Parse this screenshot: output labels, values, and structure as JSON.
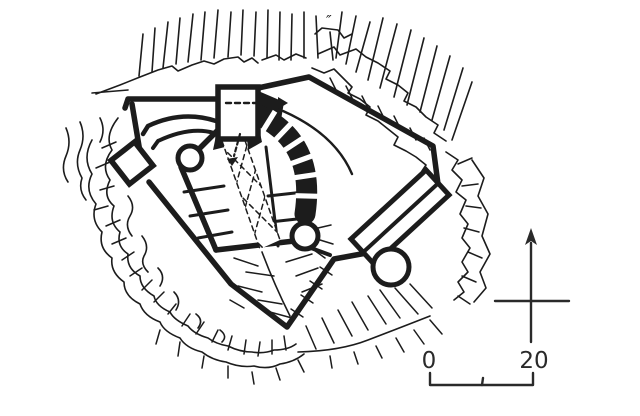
{
  "figure": {
    "type": "castle-ground-plan-scan",
    "paper_color": "#ffffff",
    "ink_color": "#1c1c1c",
    "annotation_color": "#2a2a2a",
    "ditto_mark": "″",
    "north_arrow_icon": "north-arrow",
    "scale_bar": {
      "start_label": "0",
      "end_label": "20"
    }
  }
}
